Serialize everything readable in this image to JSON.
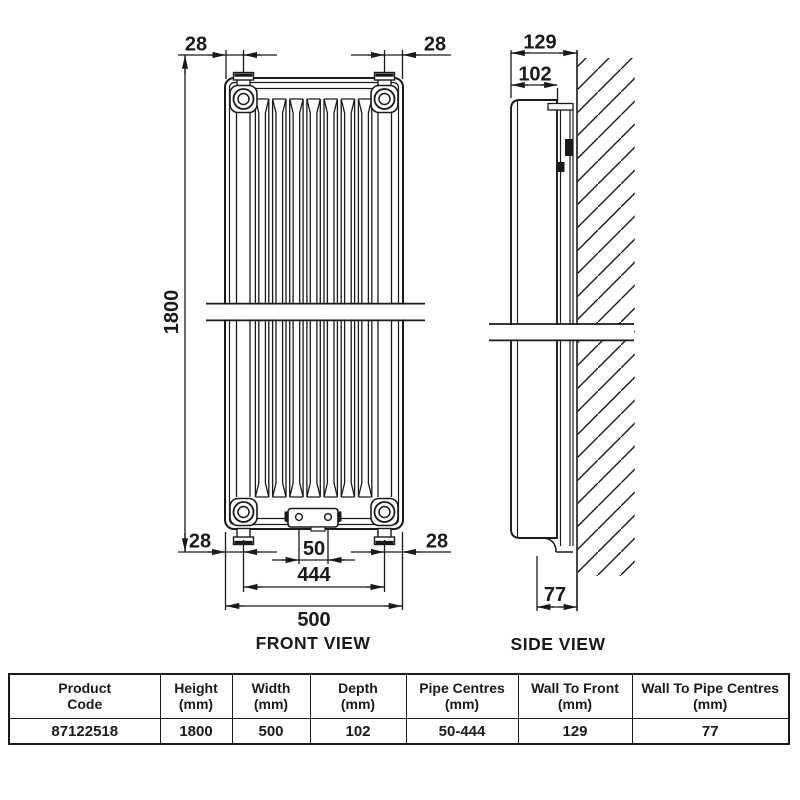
{
  "front_view": {
    "label": "FRONT VIEW",
    "dim_top_left": "28",
    "dim_top_right": "28",
    "dim_height": "1800",
    "dim_bottom_left": "28",
    "dim_bottom_right": "28",
    "dim_pipe_centres_min": "50",
    "dim_pipe_centres_max": "444",
    "dim_width": "500"
  },
  "side_view": {
    "label": "SIDE VIEW",
    "dim_wall_to_front": "129",
    "dim_depth": "102",
    "dim_wall_to_pipe_centres": "77"
  },
  "spec_table": {
    "headers": [
      {
        "line1": "Product",
        "line2": "Code"
      },
      {
        "line1": "Height",
        "line2": "(mm)"
      },
      {
        "line1": "Width",
        "line2": "(mm)"
      },
      {
        "line1": "Depth",
        "line2": "(mm)"
      },
      {
        "line1": "Pipe Centres",
        "line2": "(mm)"
      },
      {
        "line1": "Wall To Front",
        "line2": "(mm)"
      },
      {
        "line1": "Wall To Pipe Centres",
        "line2": "(mm)"
      }
    ],
    "row": {
      "product_code": "87122518",
      "height": "1800",
      "width": "500",
      "depth": "102",
      "pipe_centres": "50-444",
      "wall_to_front": "129",
      "wall_to_pipe_centres": "77"
    }
  },
  "colors": {
    "line": "#1a1a1a",
    "background": "#ffffff"
  }
}
